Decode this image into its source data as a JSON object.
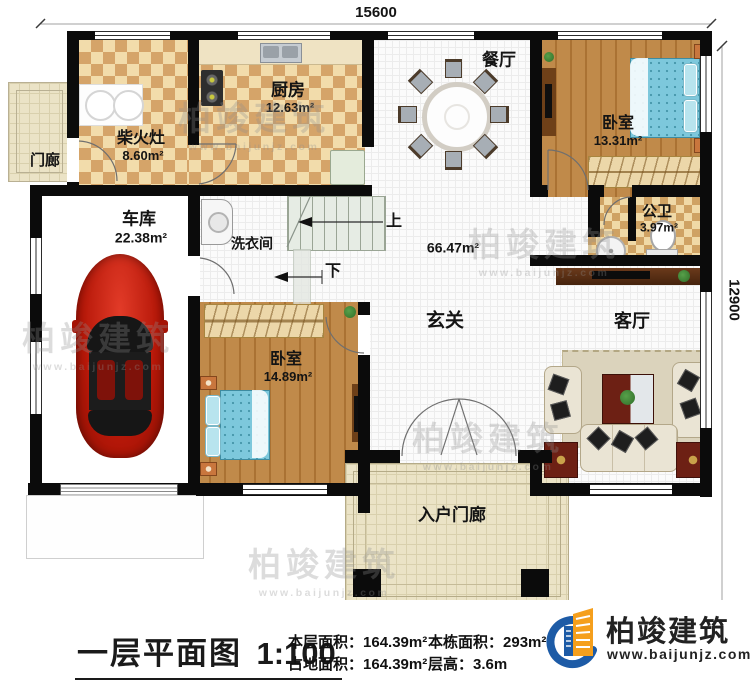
{
  "plan": {
    "dim_top": "15600",
    "dim_right": "12900",
    "rooms": {
      "chaihuozao": {
        "name": "柴火灶",
        "area": "8.60m²"
      },
      "kitchen": {
        "name": "厨房",
        "area": "12.63m²"
      },
      "porch_left": {
        "name": "门廊"
      },
      "garage": {
        "name": "车库",
        "area": "22.38m²"
      },
      "laundry": {
        "name": "洗衣间"
      },
      "dining": {
        "name": "餐厅"
      },
      "bedroom_ne": {
        "name": "卧室",
        "area": "13.31m²"
      },
      "bath": {
        "name": "公卫",
        "area": "3.97m²"
      },
      "foyer": {
        "name": "玄关",
        "area": "66.47m²"
      },
      "living": {
        "name": "客厅"
      },
      "bedroom_s": {
        "name": "卧室",
        "area": "14.89m²"
      },
      "entry_porch": {
        "name": "入户门廊"
      }
    },
    "stairs": {
      "up": "上",
      "down": "下"
    }
  },
  "footer": {
    "title": "一层平面图",
    "scale": "1:100",
    "stats": {
      "floor_area_label": "本层面积：",
      "floor_area_value": "164.39m²",
      "land_area_label": "占地面积：",
      "land_area_value": "164.39m²",
      "total_area_label": "本栋面积：",
      "total_area_value": "293m²",
      "height_label": "层高：",
      "height_value": "3.6m"
    },
    "brand": {
      "name": "柏竣建筑",
      "url": "www.baijunjz.com"
    }
  },
  "watermark": {
    "text": "柏竣建筑",
    "url": "www.baijunjz.com"
  }
}
